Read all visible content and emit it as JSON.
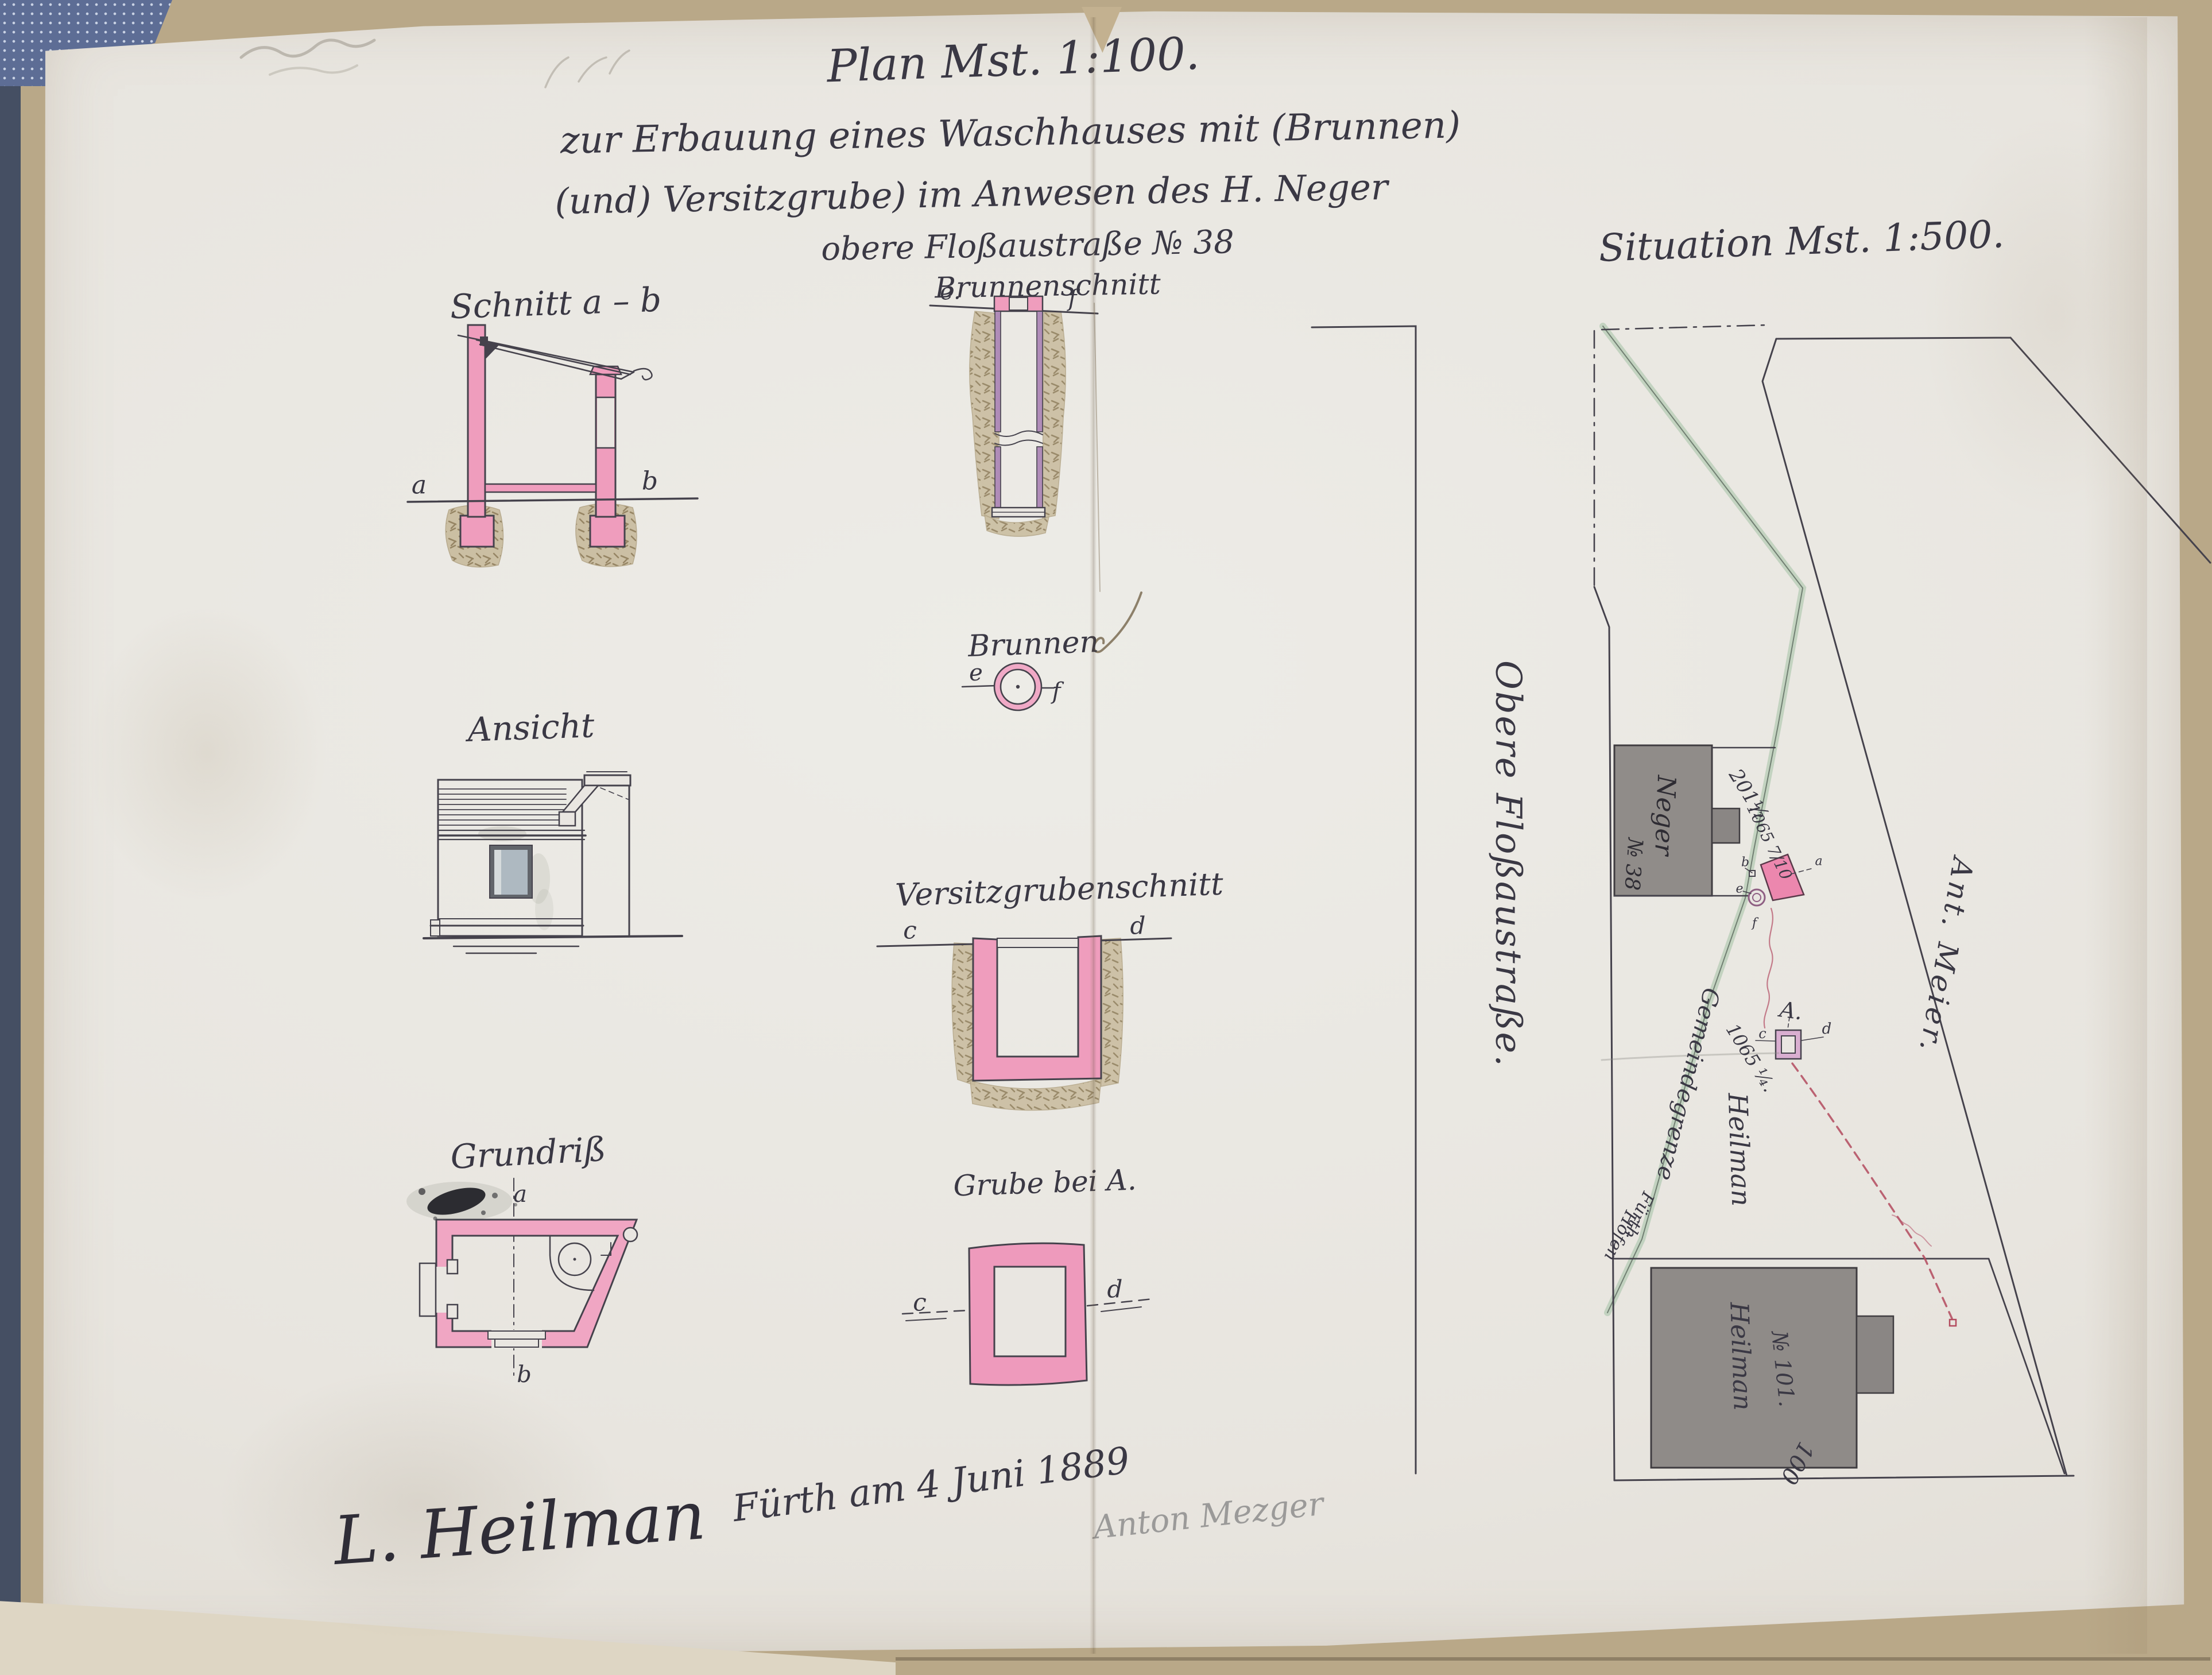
{
  "title": {
    "line1": "Plan Mst. 1:100.",
    "line2": "zur Erbauung eines Waschhauses mit (Brunnen)",
    "line3": "(und) Versitzgrube) im Anwesen des H. Neger",
    "line4": "obere Floßaustraße № 38"
  },
  "figures": {
    "brunnenschnitt": {
      "label": "Brunnenschnitt",
      "marker_left": "e.",
      "marker_right": "f"
    },
    "schnitt": {
      "label": "Schnitt a – b",
      "marker_left": "a",
      "marker_right": "b"
    },
    "brunnen": {
      "label": "Brunnen",
      "marker_left": "e",
      "marker_right": "f"
    },
    "ansicht": {
      "label": "Ansicht"
    },
    "versitzgrube": {
      "label": "Versitzgrubenschnitt",
      "marker_left": "c",
      "marker_right": "d"
    },
    "grundriss": {
      "label": "Grundriß",
      "marker_top": "a",
      "marker_bottom": "b"
    },
    "grube": {
      "label": "Grube bei A.",
      "marker_left": "c",
      "marker_right": "d"
    }
  },
  "situation": {
    "label": "Situation Mst. 1:500.",
    "street": "Obere Floßaustraße.",
    "parcels": {
      "neger": "Neger",
      "neger_no": "№ 38",
      "meier": "Ant. Meier.",
      "grenze": "Gemeindegrenze",
      "heilman_upper": "Heilman",
      "heilman_lower": "Heilman",
      "no101": "№ 101.",
      "n100": "100",
      "n201": "201½",
      "n1065a": "1065 7/10",
      "n1065b": "1065 ¼.",
      "a_label": "A.",
      "fuerth": "Fürth",
      "hoefen": "Höfen"
    },
    "markers": {
      "a": "a",
      "b": "b",
      "c": "c",
      "d": "d",
      "e": "e",
      "f": "f"
    }
  },
  "signatures": {
    "name": "L. Heilman",
    "place_date": "Fürth am 4 Juni 1889",
    "pencil": "Anton Mezger"
  },
  "colors": {
    "wall_pink": "#ef9dbd",
    "shaft_violet": "#b08cb8",
    "earth": "#c8bb9d",
    "ink": "#45424c",
    "red_ink": "#b34a5e",
    "boundary_green": "#a9c4aa",
    "building_gray": "#908c89",
    "paper": "#e9e6e1",
    "window_glass": "#aeb9c1"
  }
}
